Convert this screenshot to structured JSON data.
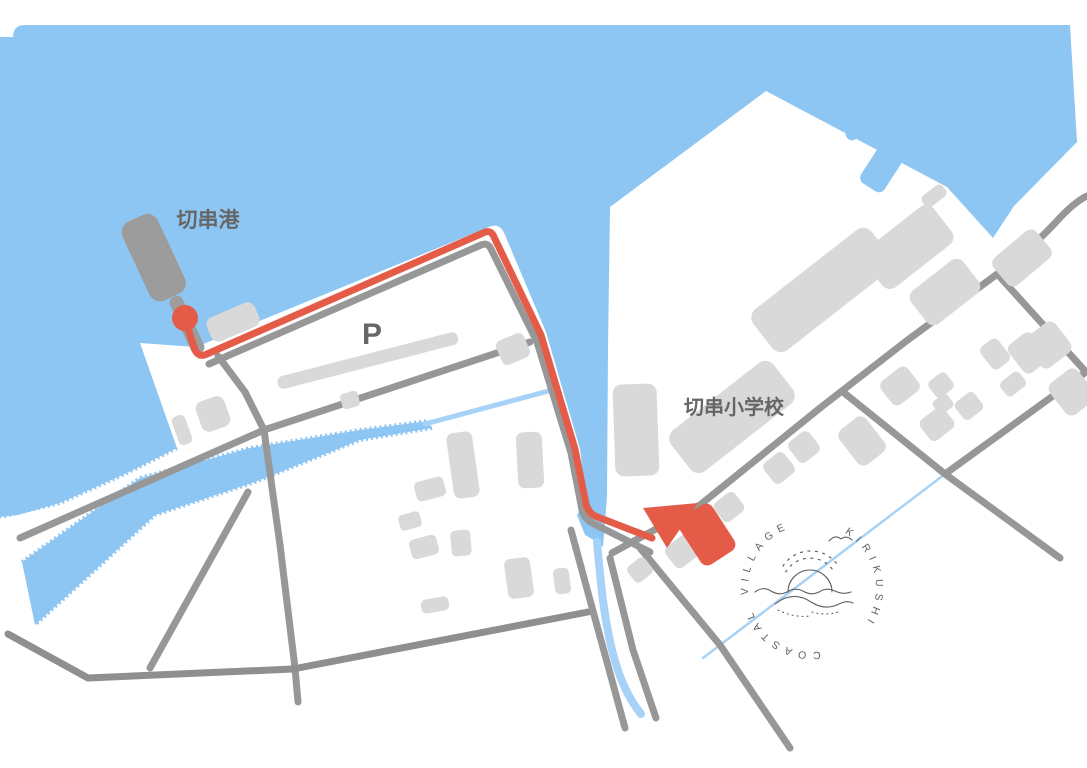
{
  "map": {
    "labels": {
      "port": "切串港",
      "parking": "P",
      "school": "切串小学校"
    },
    "logo": {
      "words": [
        "KIRIKUSHI",
        "COASTAL",
        "VILLAGE"
      ]
    },
    "colors": {
      "water": "#8EC6F3",
      "stream": "#A6D2F7",
      "land": "#FFFFFF",
      "road": "#979797",
      "building": "#D9D9D9",
      "pier": "#9C9C9C",
      "route": "#E45C48",
      "label_text": "#666666",
      "logo_ink": "#5F5F5F"
    }
  }
}
